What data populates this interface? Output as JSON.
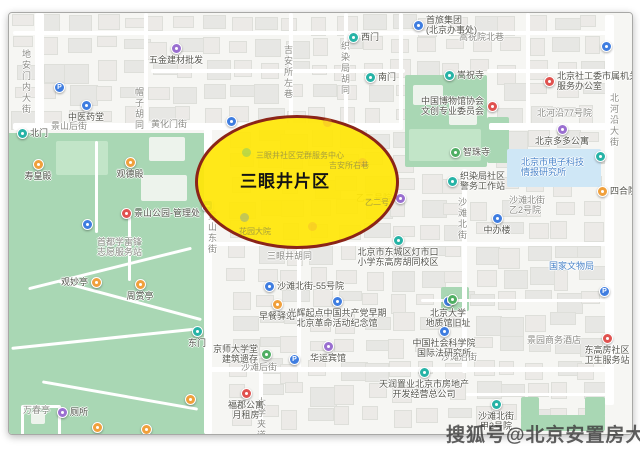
{
  "annotation": {
    "label": "三眼井片区",
    "fill": "#ffe608",
    "border": "#8b2418"
  },
  "watermark": {
    "text": "搜狐号@北京安置房大全"
  },
  "palette": {
    "purple": "#9a6fd0",
    "blue": "#3f7de0",
    "teal": "#27b3a6",
    "orange": "#f0a03c",
    "red": "#e0524f",
    "green": "#4fae63",
    "label_blue": "#4a84c9",
    "street_gray": "#8b8b86",
    "park_green": "#a9d7b4"
  },
  "area_labels": [
    {
      "lines": [
        "地安门内大街"
      ],
      "x": 20,
      "y": 48,
      "vertical": true,
      "color": "gray"
    },
    {
      "lines": [
        "帽子胡同"
      ],
      "x": 133,
      "y": 86,
      "vertical": true,
      "color": "gray"
    },
    {
      "lines": [
        "景山后街"
      ],
      "x": 50,
      "y": 120,
      "vertical": false,
      "color": "gray"
    },
    {
      "lines": [
        "黄化门街"
      ],
      "x": 150,
      "y": 118,
      "vertical": false,
      "color": "gray"
    },
    {
      "lines": [
        "吉安所左巷"
      ],
      "x": 282,
      "y": 44,
      "vertical": true,
      "color": "gray"
    },
    {
      "lines": [
        "织染局胡同"
      ],
      "x": 339,
      "y": 40,
      "vertical": true,
      "color": "gray"
    },
    {
      "lines": [
        "嵩祝院北巷"
      ],
      "x": 458,
      "y": 31,
      "vertical": false,
      "color": "gray"
    },
    {
      "lines": [
        "景山东街"
      ],
      "x": 206,
      "y": 210,
      "vertical": true,
      "color": "gray"
    },
    {
      "lines": [
        "沙滩北街"
      ],
      "x": 456,
      "y": 196,
      "vertical": true,
      "color": "gray"
    },
    {
      "lines": [
        "北河沿大街"
      ],
      "x": 608,
      "y": 92,
      "vertical": true,
      "color": "gray"
    },
    {
      "lines": [
        "沙滩后街"
      ],
      "x": 240,
      "y": 361,
      "vertical": false,
      "color": "gray"
    },
    {
      "lines": [
        "三眼井胡同"
      ],
      "x": 266,
      "y": 250,
      "vertical": false,
      "color": "gray"
    },
    {
      "lines": [
        "大学夹道"
      ],
      "x": 255,
      "y": 396,
      "vertical": true,
      "color": "gray"
    },
    {
      "lines": [
        "沙滩后街"
      ],
      "x": 440,
      "y": 351,
      "vertical": false,
      "color": "gray"
    },
    {
      "lines": [
        "万春亭"
      ],
      "x": 22,
      "y": 404,
      "vertical": false,
      "color": "gray"
    },
    {
      "lines": [
        "北河沿77号院"
      ],
      "x": 536,
      "y": 107,
      "vertical": false,
      "color": "gray"
    },
    {
      "lines": [
        "沙滩北街",
        "乙2号院"
      ],
      "x": 508,
      "y": 194,
      "vertical": false,
      "color": "gray"
    },
    {
      "lines": [
        "景园商务酒店"
      ],
      "x": 526,
      "y": 334,
      "vertical": false,
      "color": "gray"
    },
    {
      "lines": [
        "首都学雷锋",
        "志愿服务站"
      ],
      "x": 96,
      "y": 236,
      "vertical": false,
      "color": "gray"
    },
    {
      "lines": [
        "国家文物局"
      ],
      "x": 548,
      "y": 260,
      "vertical": false,
      "color": "blue"
    },
    {
      "lines": [
        "北京市电子科技",
        "情报研究所"
      ],
      "x": 520,
      "y": 156,
      "vertical": false,
      "color": "blue"
    }
  ],
  "pois": [
    {
      "lines": [
        "五金建材批发"
      ],
      "x": 175,
      "y": 47,
      "color": "purple",
      "label_pos": "b"
    },
    {
      "lines": [
        "中医药堂"
      ],
      "x": 85,
      "y": 104,
      "color": "blue",
      "label_pos": "b"
    },
    {
      "lines": [],
      "x": 58,
      "y": 86,
      "color": "blue",
      "glyph": "P"
    },
    {
      "lines": [
        "北门"
      ],
      "x": 21,
      "y": 132,
      "color": "teal",
      "label_pos": "r"
    },
    {
      "lines": [
        "寿皇殿"
      ],
      "x": 37,
      "y": 163,
      "color": "orange",
      "label_pos": "b"
    },
    {
      "lines": [
        "观德殿"
      ],
      "x": 129,
      "y": 161,
      "color": "orange",
      "label_pos": "b"
    },
    {
      "lines": [
        "景山公园-管理处"
      ],
      "x": 125,
      "y": 212,
      "color": "red",
      "label_pos": "r"
    },
    {
      "lines": [],
      "x": 86,
      "y": 223,
      "color": "blue"
    },
    {
      "lines": [
        "观妙亭"
      ],
      "x": 95,
      "y": 281,
      "color": "orange",
      "label_pos": "l"
    },
    {
      "lines": [
        "周赏亭"
      ],
      "x": 139,
      "y": 283,
      "color": "orange",
      "label_pos": "b"
    },
    {
      "lines": [],
      "x": 189,
      "y": 398,
      "color": "orange"
    },
    {
      "lines": [],
      "x": 96,
      "y": 426,
      "color": "orange"
    },
    {
      "lines": [],
      "x": 145,
      "y": 428,
      "color": "orange"
    },
    {
      "lines": [
        "厕所"
      ],
      "x": 61,
      "y": 411,
      "color": "purple",
      "label_pos": "r"
    },
    {
      "lines": [
        "东门"
      ],
      "x": 196,
      "y": 330,
      "color": "teal",
      "label_pos": "b"
    },
    {
      "lines": [],
      "x": 206,
      "y": 204,
      "color": "blue",
      "glyph": "bus"
    },
    {
      "lines": [],
      "x": 230,
      "y": 120,
      "color": "blue"
    },
    {
      "lines": [
        "西门"
      ],
      "x": 352,
      "y": 36,
      "color": "teal",
      "label_pos": "r"
    },
    {
      "lines": [
        "南门"
      ],
      "x": 369,
      "y": 76,
      "color": "teal",
      "label_pos": "r"
    },
    {
      "lines": [
        "首旅集团",
        "(北京办事处)"
      ],
      "x": 417,
      "y": 24,
      "color": "blue",
      "label_pos": "r"
    },
    {
      "lines": [
        "嵩祝寺"
      ],
      "x": 448,
      "y": 74,
      "color": "teal",
      "label_pos": "r"
    },
    {
      "lines": [
        "中国博物馆协会",
        "文创专业委员会"
      ],
      "x": 491,
      "y": 105,
      "color": "red",
      "label_pos": "l"
    },
    {
      "lines": [
        "北京社工委市属机关",
        "服务办公室"
      ],
      "x": 548,
      "y": 80,
      "color": "red",
      "label_pos": "r"
    },
    {
      "lines": [
        "北京多多公寓"
      ],
      "x": 561,
      "y": 128,
      "color": "purple",
      "label_pos": "b"
    },
    {
      "lines": [],
      "x": 605,
      "y": 45,
      "color": "blue"
    },
    {
      "lines": [],
      "x": 599,
      "y": 155,
      "color": "teal"
    },
    {
      "lines": [
        "四合院"
      ],
      "x": 601,
      "y": 190,
      "color": "orange",
      "label_pos": "r"
    },
    {
      "lines": [
        "智珠寺"
      ],
      "x": 454,
      "y": 151,
      "color": "green",
      "label_pos": "r"
    },
    {
      "lines": [
        "织染局社区",
        "警务工作站"
      ],
      "x": 451,
      "y": 180,
      "color": "teal",
      "label_pos": "r"
    },
    {
      "lines": [
        "中办楼"
      ],
      "x": 496,
      "y": 217,
      "color": "blue",
      "label_pos": "b"
    },
    {
      "lines": [
        "乙二号院"
      ],
      "x": 399,
      "y": 197,
      "color": "purple",
      "label_pos": "l"
    },
    {
      "lines": [
        "北京市东城区灯市口",
        "小学东高房胡同校区"
      ],
      "x": 397,
      "y": 239,
      "color": "teal",
      "label_pos": "b"
    },
    {
      "lines": [
        "沙滩北街-55号院"
      ],
      "x": 268,
      "y": 285,
      "color": "blue",
      "label_pos": "r"
    },
    {
      "lines": [
        "早餐驿站"
      ],
      "x": 276,
      "y": 303,
      "color": "orange",
      "label_pos": "b"
    },
    {
      "lines": [
        "光辉起点中国共产党早期",
        "北京革命活动纪念馆"
      ],
      "x": 336,
      "y": 300,
      "color": "blue",
      "label_pos": "b"
    },
    {
      "lines": [
        "京师大学堂",
        "建筑遗存"
      ],
      "x": 265,
      "y": 353,
      "color": "green",
      "label_pos": "l"
    },
    {
      "lines": [
        "华运宾馆"
      ],
      "x": 327,
      "y": 345,
      "color": "purple",
      "label_pos": "b"
    },
    {
      "lines": [],
      "x": 293,
      "y": 358,
      "color": "blue",
      "glyph": "P"
    },
    {
      "lines": [
        "福郡公寓",
        "月租房"
      ],
      "x": 245,
      "y": 392,
      "color": "red",
      "label_pos": "b"
    },
    {
      "lines": [
        "天润置业北京市房地产",
        "开发经营总公司"
      ],
      "x": 423,
      "y": 371,
      "color": "teal",
      "label_pos": "b"
    },
    {
      "lines": [
        "北京大学",
        "地质馆旧址"
      ],
      "x": 447,
      "y": 300,
      "color": "blue",
      "label_pos": "b"
    },
    {
      "lines": [
        "中国社会科学院",
        "国际法研究所"
      ],
      "x": 443,
      "y": 330,
      "color": "blue",
      "label_pos": "b"
    },
    {
      "lines": [
        "东高房社区",
        "卫生服务站"
      ],
      "x": 606,
      "y": 337,
      "color": "red",
      "label_pos": "b"
    },
    {
      "lines": [
        "沙滩北街",
        "甲2号院"
      ],
      "x": 495,
      "y": 403,
      "color": "teal",
      "label_pos": "b"
    },
    {
      "lines": [],
      "x": 603,
      "y": 290,
      "color": "blue",
      "glyph": "P"
    },
    {
      "lines": [],
      "x": 451,
      "y": 298,
      "color": "green"
    }
  ],
  "covered_labels": [
    {
      "lines": [
        "三眼井社区党群服务中心"
      ],
      "x": 255,
      "y": 149
    },
    {
      "lines": [
        "吉安所右巷"
      ],
      "x": 328,
      "y": 159
    },
    {
      "lines": [
        "花园大院"
      ],
      "x": 238,
      "y": 225
    },
    {
      "lines": [
        "乙二号"
      ],
      "x": 364,
      "y": 196
    }
  ],
  "covered_icons": [
    {
      "x": 245,
      "y": 151,
      "color": "teal"
    },
    {
      "x": 361,
      "y": 161,
      "color": "orange"
    },
    {
      "x": 311,
      "y": 225,
      "color": "orange"
    },
    {
      "x": 243,
      "y": 216,
      "color": "blue"
    },
    {
      "x": 326,
      "y": 121,
      "color": "orange"
    }
  ]
}
